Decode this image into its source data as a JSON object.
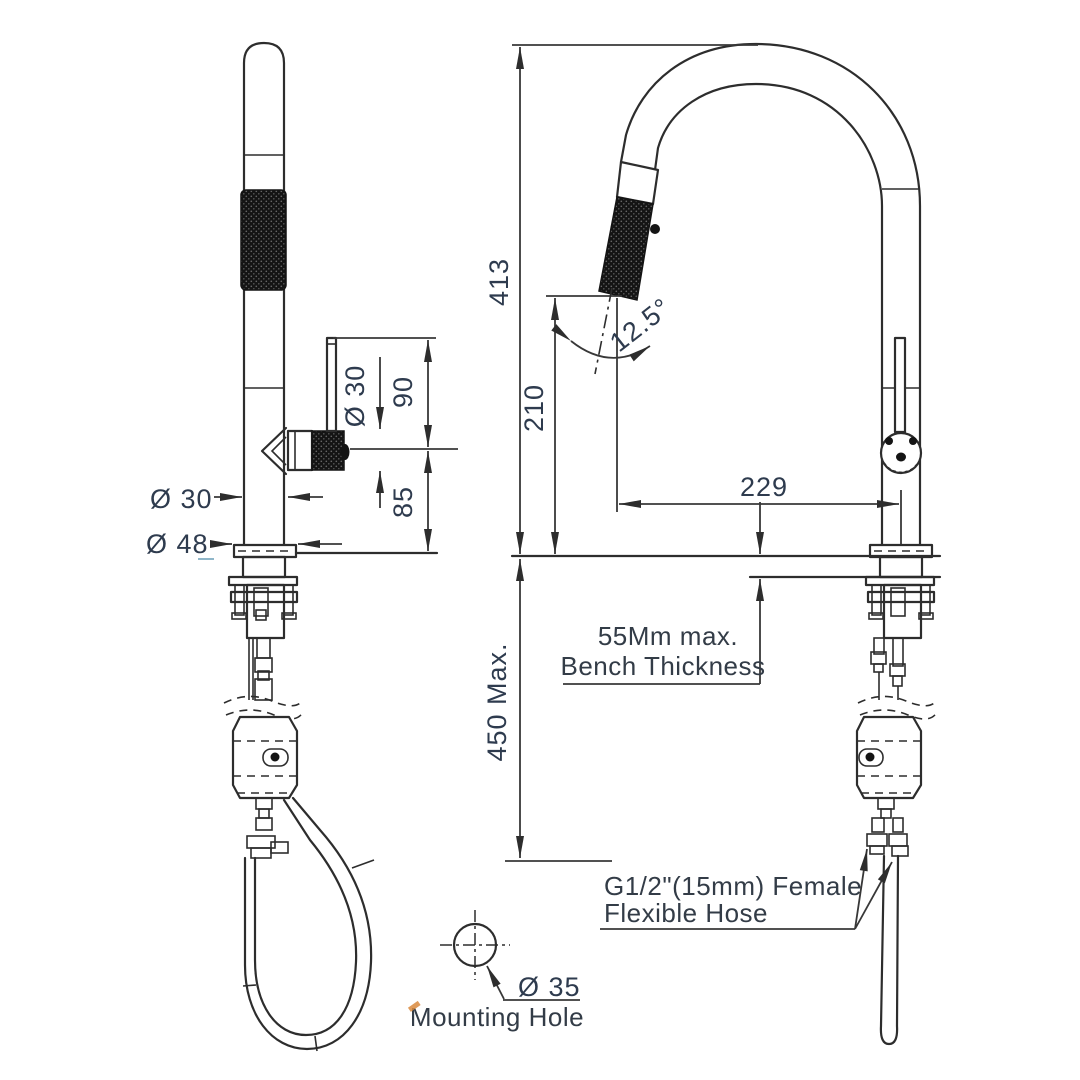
{
  "drawing": {
    "subject": "Pull-out kitchen sink mixer tap - dimensioned technical drawing, spray-wand side view and gooseneck front view",
    "background_color": "#ffffff",
    "line_color": "#2d2d2d",
    "dimension_text_color": "#2e3b4e",
    "units": "mm"
  },
  "dimensions": {
    "overall_height": "413",
    "outlet_height": "210",
    "spout_reach": "229",
    "spray_head_angle": "12.5°",
    "lever_span": "90",
    "handle_above_bench": "85",
    "body_diameter": "Ø 30",
    "handle_diameter": "Ø 30",
    "base_flange_diameter": "Ø 48",
    "hose_drop_below_bench": "450 Max.",
    "mounting_hole_diameter": "Ø 35"
  },
  "annotations": {
    "bench_note_line1": "55Mm max.",
    "bench_note_line2": "Bench Thickness",
    "hose_note_line1": "G1/2\"(15mm) Female",
    "hose_note_line2": "Flexible Hose",
    "mounting_hole_label": "Mounting Hole"
  }
}
